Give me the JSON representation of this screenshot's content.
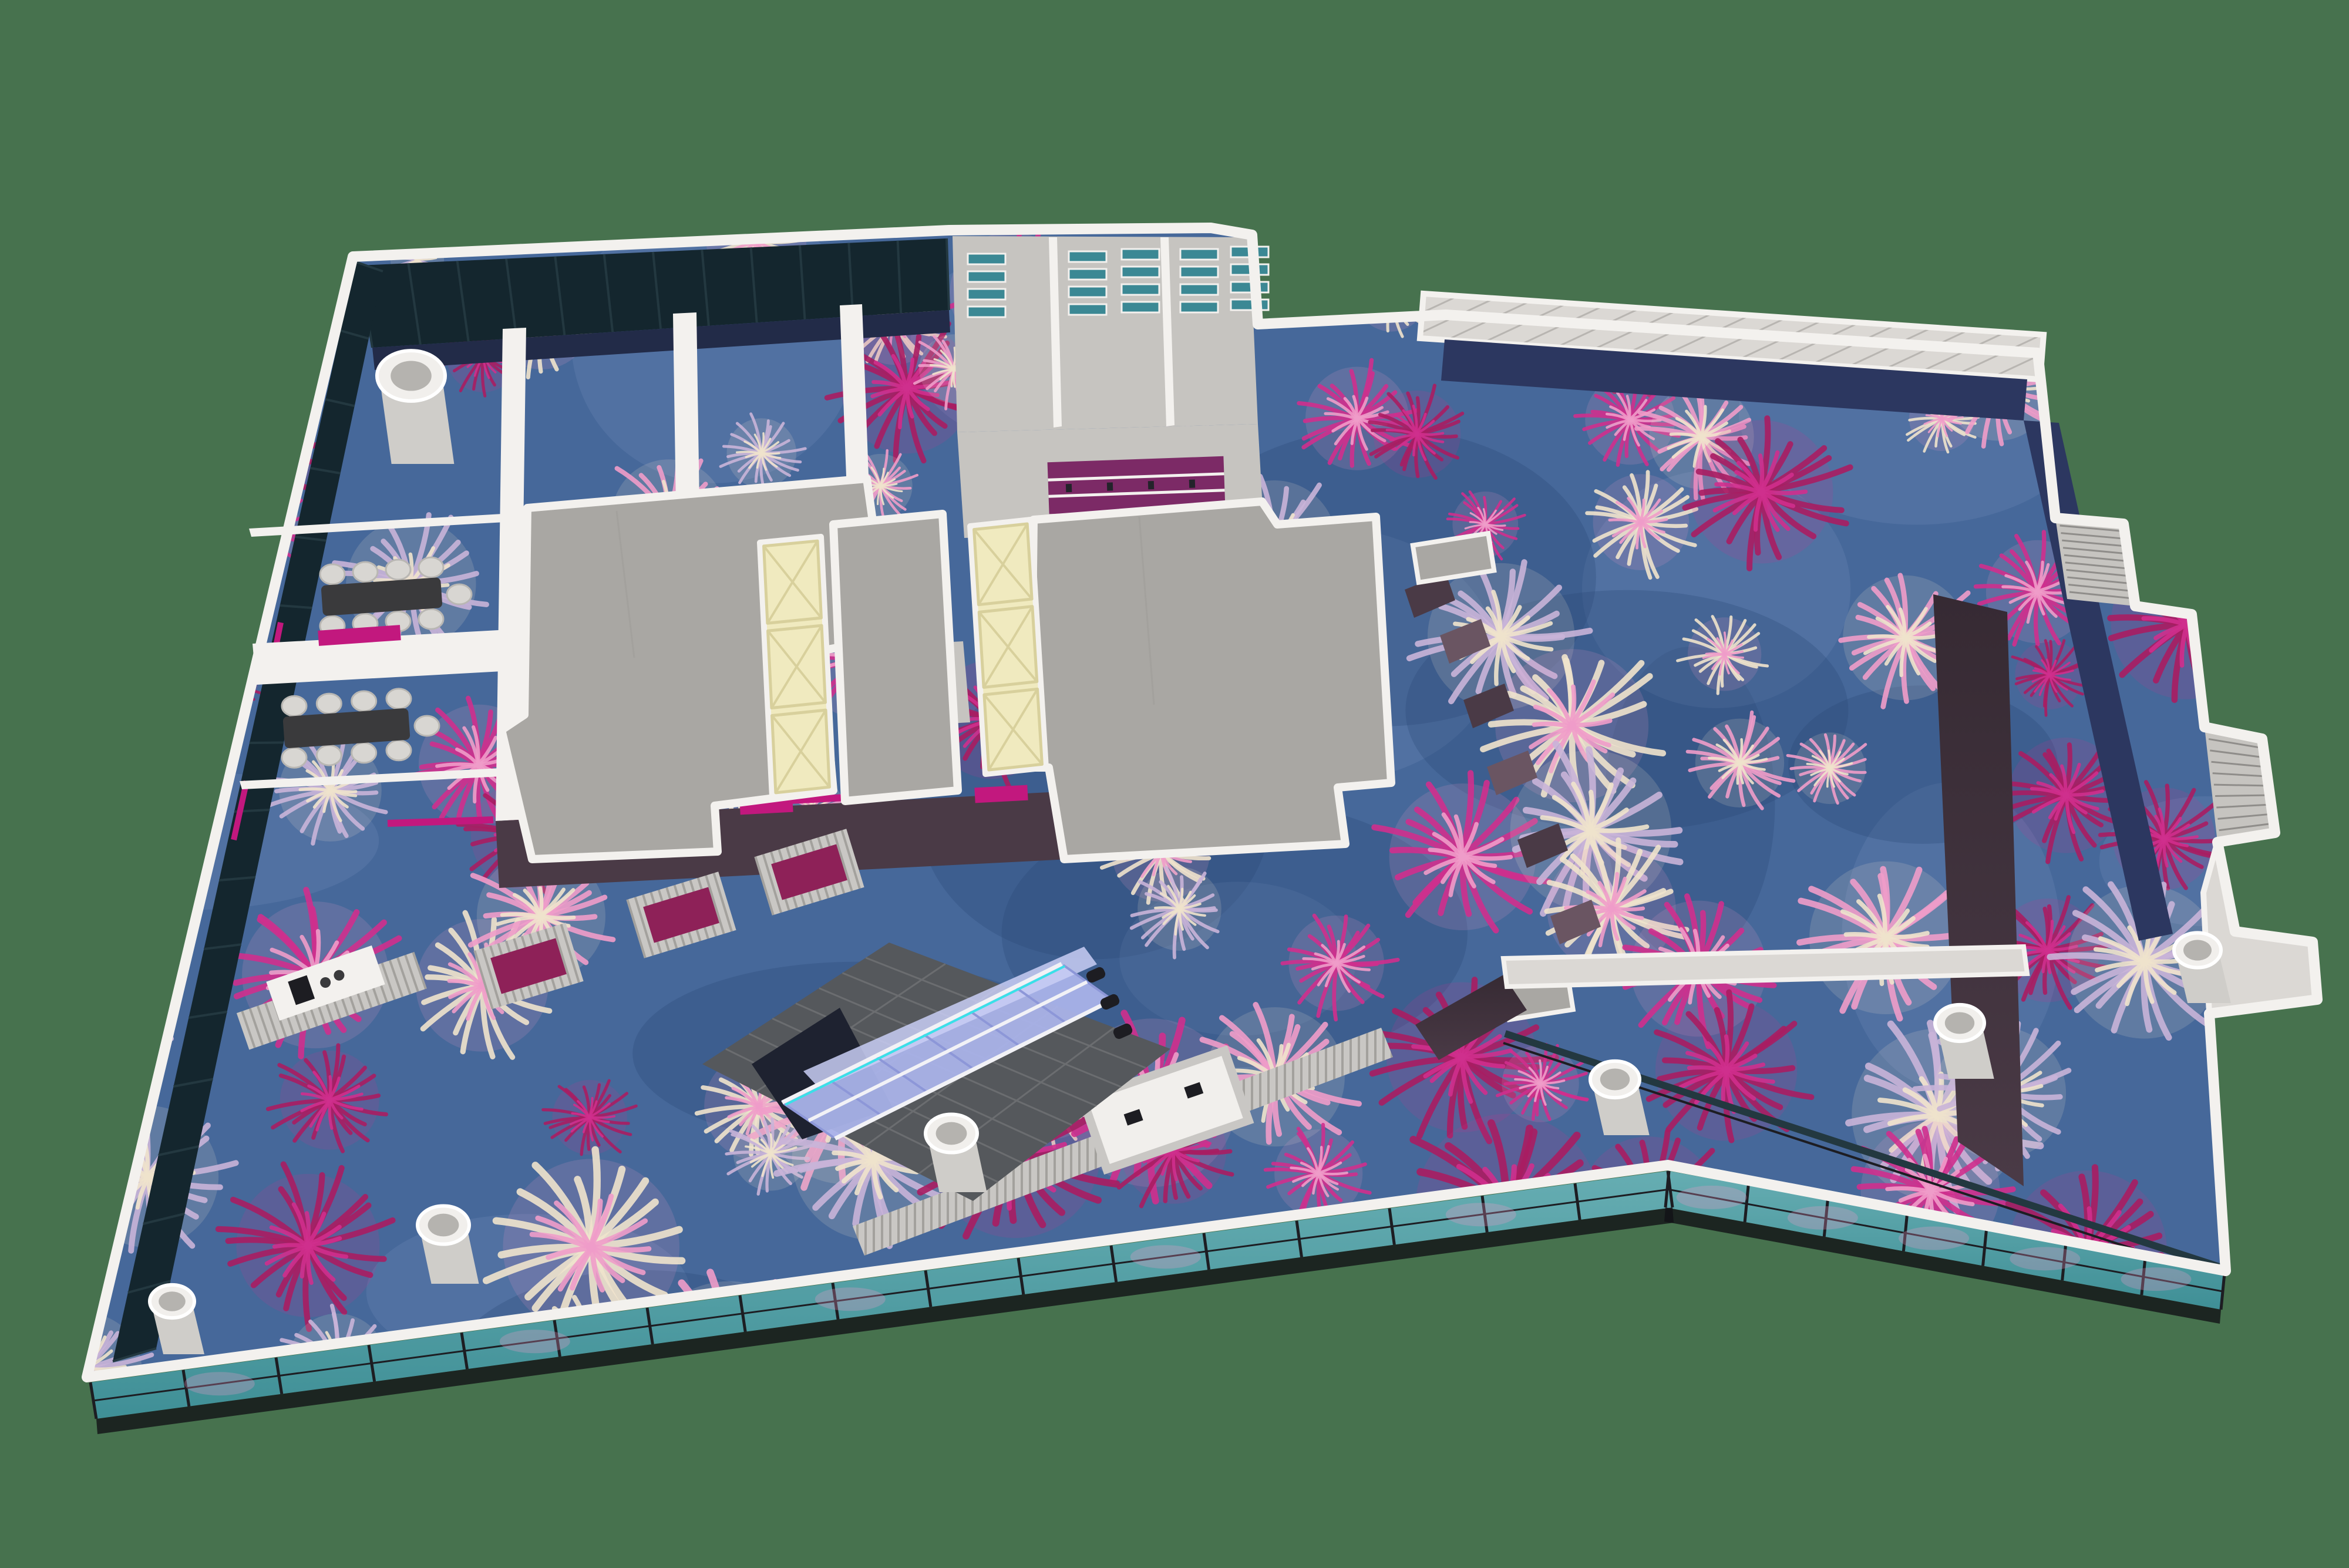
{
  "title": "3d-floorplan-render",
  "colors": {
    "background": "#47724e",
    "carpet_base": "#46689a",
    "carpet_shadow": "#2c4a78",
    "carpet_light": "#7b97c2",
    "flower_magenta": "#cf2f8d",
    "flower_deep": "#a81d62",
    "flower_pink": "#ef9cc9",
    "flower_cream": "#efe3cc",
    "flower_lavender": "#c9b4d8",
    "concrete": "#a9a7a3",
    "concrete_light": "#c6c4c0",
    "wall_white": "#f3f1ee",
    "wall_cap": "#dbd8d4",
    "cap_stripe": "#b8b5b1",
    "navy": "#2c3760",
    "curtain_navy": "#222b48",
    "glass_dark": "#14262e",
    "glass_mullion": "#233840",
    "facade_teal": "#3f8f96",
    "facade_teal_light": "#66adb2",
    "frame_dark": "#1d1d22",
    "skylight": "#f0eabf",
    "skylight_frame": "#d8d09c",
    "plum": "#4a3a46",
    "plum_light": "#6a5562",
    "magenta": "#c2187e",
    "magenta_panel": "#8e2158",
    "teal_shelf": "#3b8894",
    "bar_purple": "#7c2a66",
    "esc_glass": "#aab4ea",
    "esc_glass_light": "#c9cef4",
    "esc_cyan": "#3ae0e8",
    "tile_dark": "#55585c",
    "tile_grid": "#6b6d70",
    "table_dark": "#3a3a3c",
    "chair": "#d8d6d2",
    "column_body": "#cfcdc9",
    "column_top": "#f1efec",
    "column_inner": "#b5b3af",
    "rib_light": "#c9c7c4",
    "rib_line": "#a3a19d"
  },
  "scene": {
    "view": "axonometric-floor-plan-render",
    "skylight_strips": 2,
    "skylight_panels_per_strip": 3,
    "escalator_handrails": 3,
    "columns": 7,
    "meeting_rooms": 2,
    "meeting_chairs_per_room": 9,
    "magenta_alcoves": 3,
    "pink_doors": 3,
    "boh_shelf_rooms": 3,
    "stair_pockets": 2
  }
}
